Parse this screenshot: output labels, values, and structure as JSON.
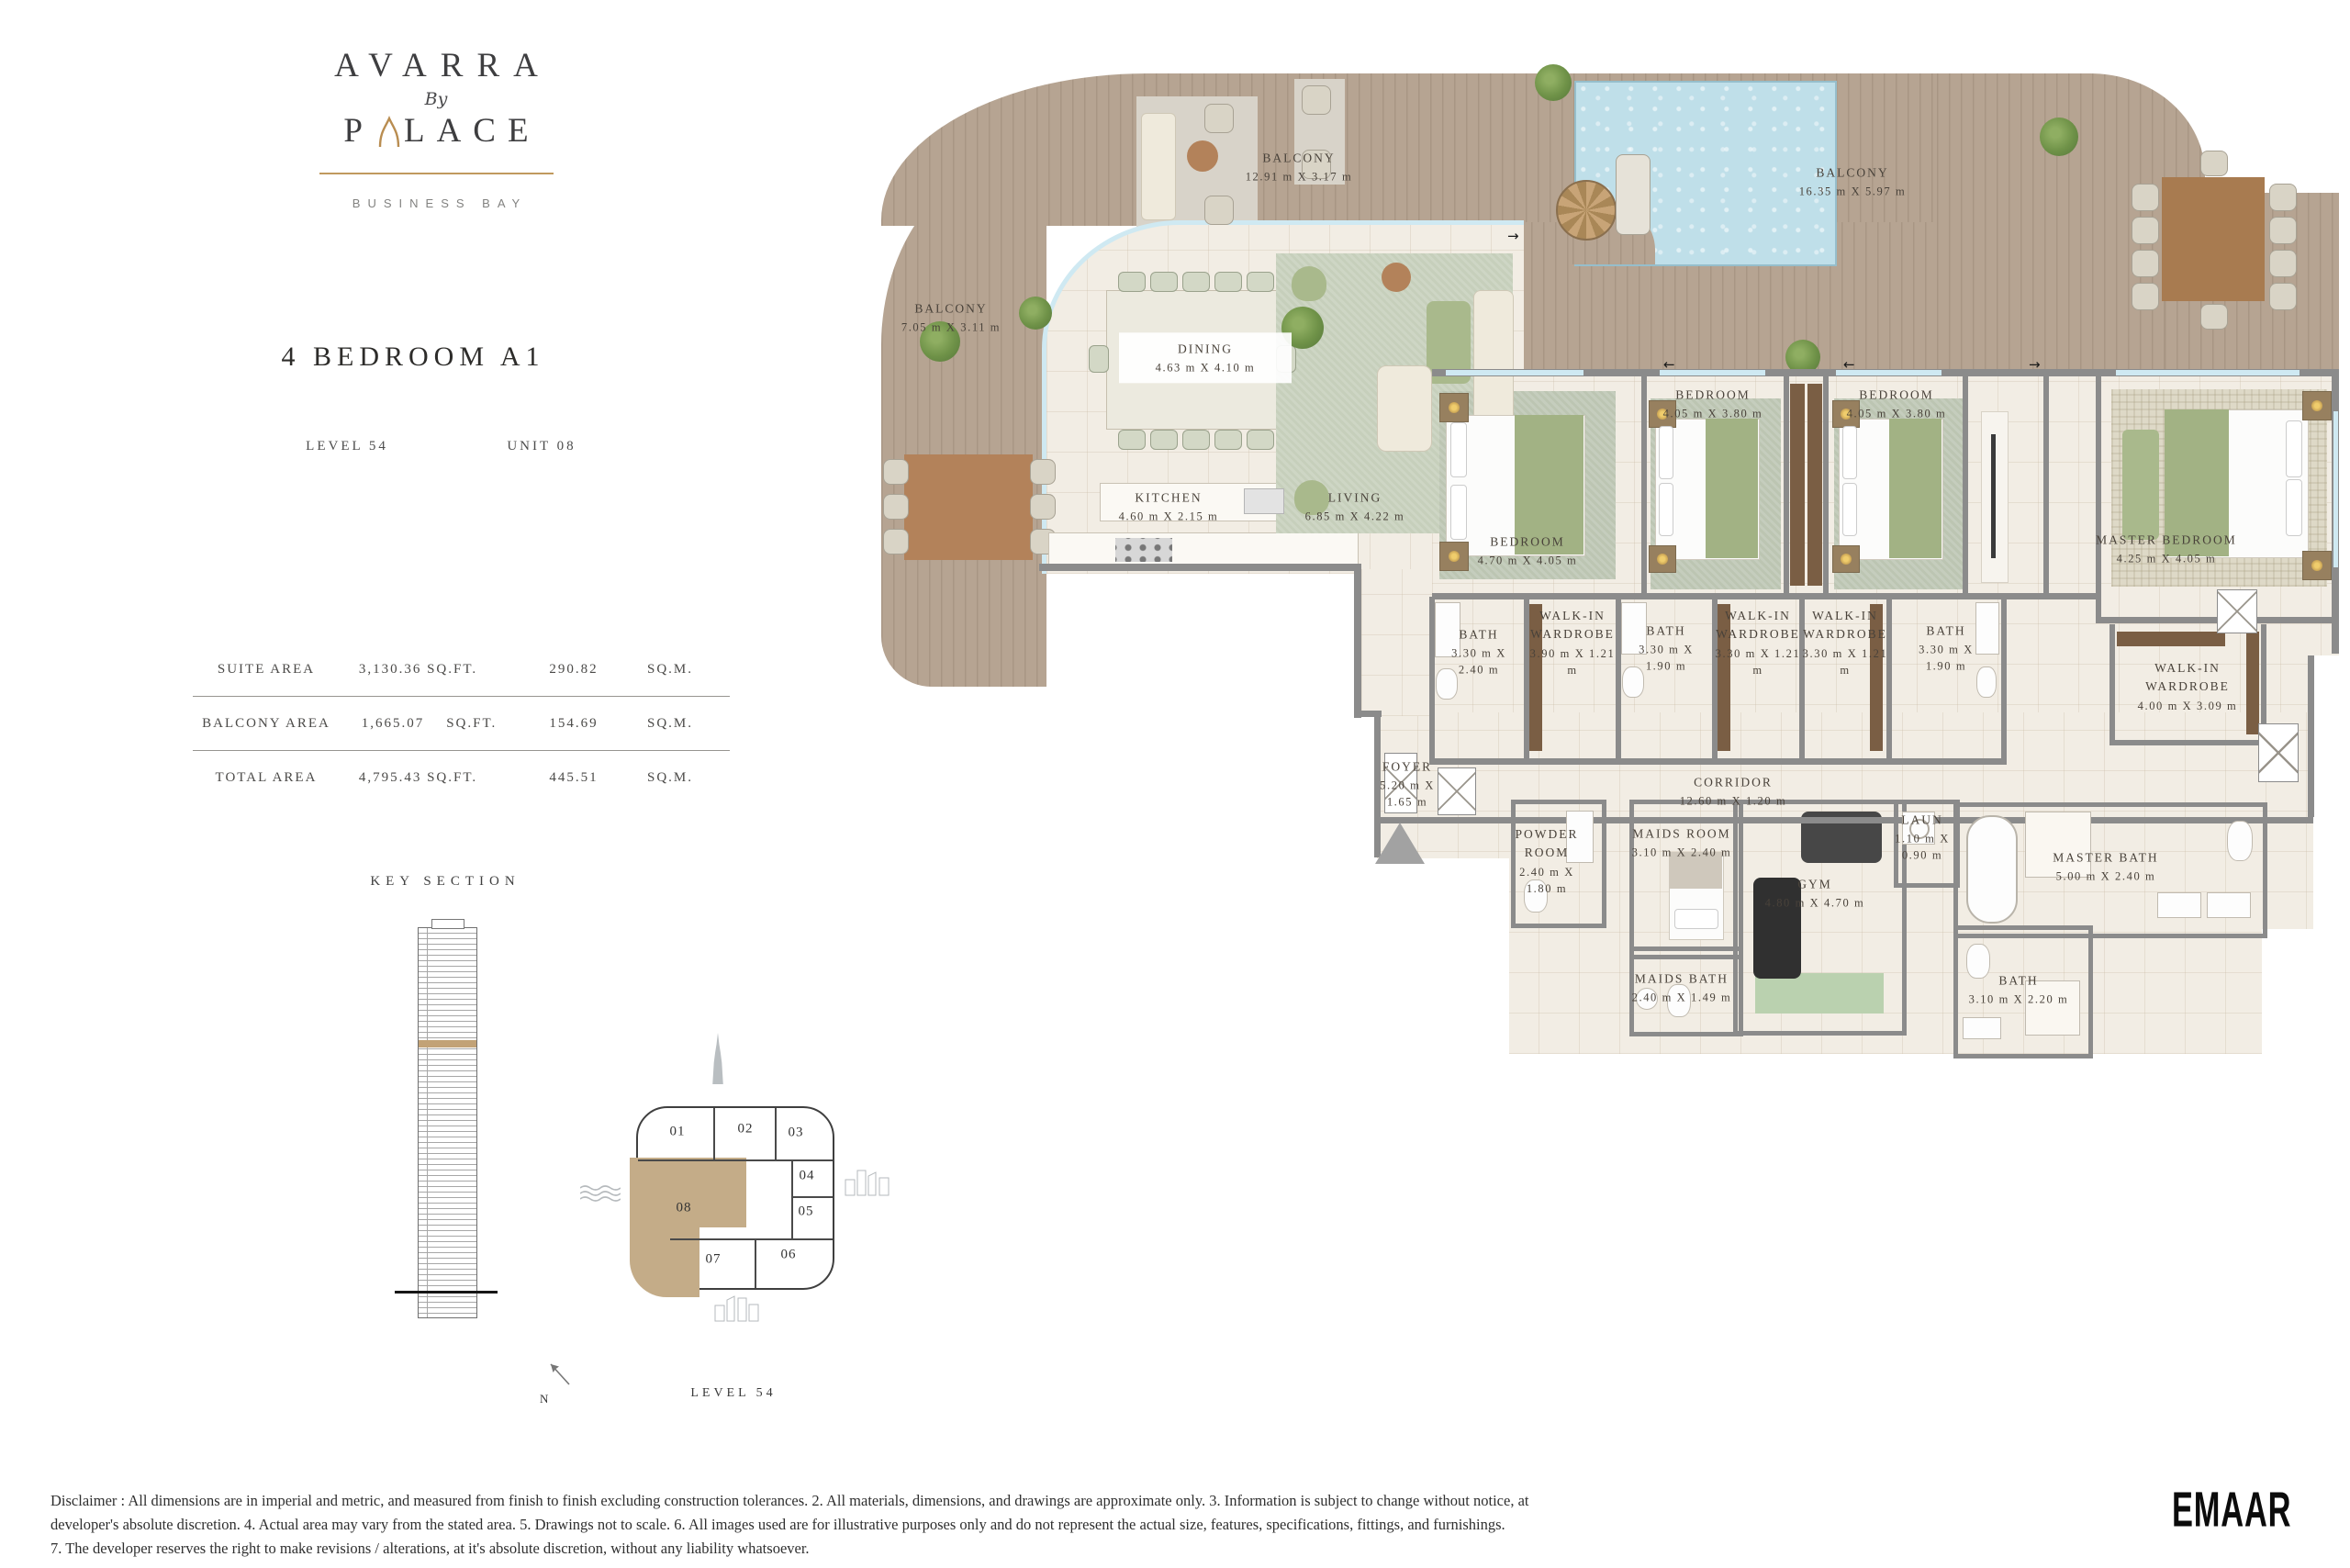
{
  "brand": {
    "name": "AVARRA",
    "by": "By",
    "palace_first": "P",
    "palace_rest": "LACE",
    "location": "BUSINESS BAY"
  },
  "unit": {
    "title": "4 BEDROOM A1",
    "level": "LEVEL 54",
    "unit": "UNIT 08"
  },
  "area_table": {
    "rows": [
      {
        "label": "SUITE AREA",
        "sqft": "3,130.36 SQ.FT.",
        "sqft_unit": "",
        "sqm": "290.82",
        "sqm_unit": "SQ.M."
      },
      {
        "label": "BALCONY AREA",
        "sqft": "1,665.07",
        "sqft_unit": "SQ.FT.",
        "sqm": "154.69",
        "sqm_unit": "SQ.M."
      },
      {
        "label": "TOTAL AREA",
        "sqft": "4,795.43 SQ.FT.",
        "sqft_unit": "",
        "sqm": "445.51",
        "sqm_unit": "SQ.M."
      }
    ]
  },
  "key_section": {
    "title": "KEY SECTION"
  },
  "key_plan": {
    "level": "LEVEL 54",
    "north": "N",
    "highlight_color": "#c4ac88",
    "units": [
      {
        "id": "01"
      },
      {
        "id": "02"
      },
      {
        "id": "03"
      },
      {
        "id": "04"
      },
      {
        "id": "05"
      },
      {
        "id": "06"
      },
      {
        "id": "07"
      },
      {
        "id": "08"
      }
    ]
  },
  "plan": {
    "rooms": [
      {
        "name": "BALCONY",
        "dims": "12.91 m X 3.17 m"
      },
      {
        "name": "BALCONY",
        "dims": "7.05 m X 3.11 m"
      },
      {
        "name": "BALCONY",
        "dims": "16.35 m X 5.97 m"
      },
      {
        "name": "DINING",
        "dims": "4.63 m X 4.10 m"
      },
      {
        "name": "KITCHEN",
        "dims": "4.60 m X 2.15 m"
      },
      {
        "name": "LIVING",
        "dims": "6.85 m X 4.22 m"
      },
      {
        "name": "BEDROOM",
        "dims": "4.70 m X 4.05 m"
      },
      {
        "name": "BEDROOM",
        "dims": "4.05 m X 3.80 m"
      },
      {
        "name": "BEDROOM",
        "dims": "4.05 m X 3.80 m"
      },
      {
        "name": "MASTER BEDROOM",
        "dims": "4.25 m X 4.05 m"
      },
      {
        "name": "BATH",
        "dims": "3.30 m X 2.40 m"
      },
      {
        "name": "WALK-IN WARDROBE",
        "dims": "3.90 m X 1.21 m"
      },
      {
        "name": "BATH",
        "dims": "3.30 m X 1.90 m"
      },
      {
        "name": "WALK-IN WARDROBE",
        "dims": "3.30 m X 1.21 m"
      },
      {
        "name": "WALK-IN WARDROBE",
        "dims": "3.30 m X 1.21 m"
      },
      {
        "name": "BATH",
        "dims": "3.30 m X 1.90 m"
      },
      {
        "name": "WALK-IN WARDROBE",
        "dims": "4.00 m X 3.09 m"
      },
      {
        "name": "FOYER",
        "dims": "5.20 m X 1.65 m"
      },
      {
        "name": "CORRIDOR",
        "dims": "12.60 m X 1.20 m"
      },
      {
        "name": "POWDER ROOM",
        "dims": "2.40 m X 1.80 m"
      },
      {
        "name": "MAIDS ROOM",
        "dims": "3.10 m X 2.40 m"
      },
      {
        "name": "MAIDS BATH",
        "dims": "2.40 m X 1.49 m"
      },
      {
        "name": "GYM",
        "dims": "4.80 m X 4.70 m"
      },
      {
        "name": "LAUN",
        "dims": "1.10 m X 0.90 m"
      },
      {
        "name": "MASTER BATH",
        "dims": "5.00 m X 2.40 m"
      },
      {
        "name": "BATH",
        "dims": "3.10 m X 2.20 m"
      }
    ]
  },
  "icons": {
    "arrow_right": "→",
    "arrow_left": "←"
  },
  "footer": {
    "disclaimer": [
      "Disclaimer : All dimensions are in imperial and metric, and measured from finish to finish excluding construction tolerances. 2. All materials, dimensions, and drawings are approximate only. 3. Information is subject to change without notice, at",
      "developer's absolute discretion. 4. Actual area may vary from the stated area. 5. Drawings not to scale. 6. All images used are for illustrative purposes only and do not represent the actual size, features, specifications, fittings, and furnishings.",
      "7. The developer reserves the right to make revisions / alterations, at it's absolute discretion, without any liability whatsoever."
    ],
    "logo": "EMAAR"
  }
}
